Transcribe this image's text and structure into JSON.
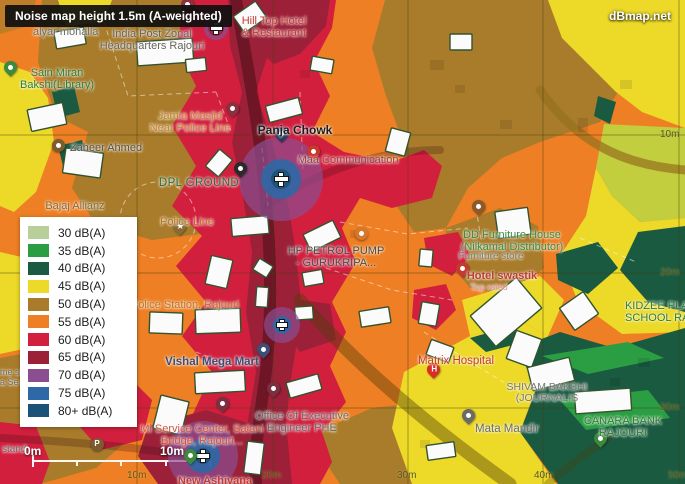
{
  "header": {
    "title": "Noise map height 1.5m (A-weighted)",
    "brand": "dBmap.net"
  },
  "colors": {
    "db30": "#b8cf9a",
    "db35": "#2b9e43",
    "db40": "#195a41",
    "db45": "#ecd928",
    "db50": "#a97c2b",
    "db55": "#ee7f24",
    "db60": "#d31f3e",
    "db65": "#9c2138",
    "db70": "#8b4f91",
    "db75": "#2e68a6",
    "db80": "#1c5278"
  },
  "legend": {
    "items": [
      {
        "label": "30 dB(A)",
        "color": "#b8cf9a"
      },
      {
        "label": "35 dB(A)",
        "color": "#2b9e43"
      },
      {
        "label": "40 dB(A)",
        "color": "#195a41"
      },
      {
        "label": "45 dB(A)",
        "color": "#ecd928"
      },
      {
        "label": "50 dB(A)",
        "color": "#a97c2b"
      },
      {
        "label": "55 dB(A)",
        "color": "#ee7f24"
      },
      {
        "label": "60 dB(A)",
        "color": "#d31f3e"
      },
      {
        "label": "65 dB(A)",
        "color": "#9c2138"
      },
      {
        "label": "70 dB(A)",
        "color": "#8b4f91"
      },
      {
        "label": "75 dB(A)",
        "color": "#2e68a6"
      },
      {
        "label": "80+ dB(A)",
        "color": "#1c5278"
      }
    ]
  },
  "scale_bar": {
    "start_label": "0m",
    "end_label": "10m"
  },
  "grid": {
    "bottom_labels": [
      {
        "text": "10m",
        "x": 137
      },
      {
        "text": "20m",
        "x": 272
      },
      {
        "text": "30m",
        "x": 407
      },
      {
        "text": "40m",
        "x": 544
      },
      {
        "text": "50m",
        "x": 678
      }
    ],
    "right_labels": [
      {
        "text": "10m",
        "y": 129
      },
      {
        "text": "20m",
        "y": 267
      },
      {
        "text": "30m",
        "y": 402
      }
    ]
  },
  "map": {
    "labels": [
      {
        "name": "label-alyar-mohalla",
        "lines": [
          "alyar mohalla"
        ],
        "x": 33,
        "y": 27,
        "color": "#6e6a60",
        "size": 11,
        "align": "left"
      },
      {
        "name": "label-india-post",
        "lines": [
          "India Post Zonal",
          "Headquarters Rajouri"
        ],
        "x": 152,
        "y": 29,
        "color": "#67635b",
        "size": 11
      },
      {
        "name": "label-hilltop-hotel",
        "lines": [
          "Hill Top Hotel",
          "& Restaurant"
        ],
        "x": 274,
        "y": 16,
        "color": "#c5392f",
        "size": 11
      },
      {
        "name": "label-sain-miran-library",
        "lines": [
          "Sain Miran",
          "Bakshi(Library)"
        ],
        "x": 57,
        "y": 68,
        "color": "#2f7d32",
        "size": 11
      },
      {
        "name": "label-jamia-masjid",
        "lines": [
          "Jamia Masjid",
          "Near Police Line"
        ],
        "x": 190,
        "y": 111,
        "color": "#c8812c",
        "size": 11
      },
      {
        "name": "label-panja-chowk",
        "lines": [
          "Panja Chowk"
        ],
        "x": 295,
        "y": 124,
        "color": "#1c1c1e",
        "size": 12,
        "bold": true
      },
      {
        "name": "label-maa-communication",
        "lines": [
          "Maa Communication"
        ],
        "x": 348,
        "y": 155,
        "color": "#9a423a",
        "size": 11
      },
      {
        "name": "label-dpl-ground",
        "lines": [
          "DPL GROUND"
        ],
        "x": 199,
        "y": 177,
        "color": "#2e6b34",
        "size": 11.5,
        "spacing": 0.4
      },
      {
        "name": "label-zaheer-ahmed",
        "lines": [
          "Zaheer Ahmed"
        ],
        "x": 106,
        "y": 143,
        "color": "#565149",
        "size": 11
      },
      {
        "name": "label-bajaj-allianz",
        "lines": [
          "Bajaj Allianz"
        ],
        "x": 75,
        "y": 201,
        "color": "#8a6a33",
        "size": 11
      },
      {
        "name": "label-police-line",
        "lines": [
          "Police Line"
        ],
        "x": 187,
        "y": 217,
        "color": "#bd7222",
        "size": 11
      },
      {
        "name": "label-hp-petrol-pump",
        "lines": [
          "HP PETROL PUMP",
          "- GURUKRIPA..."
        ],
        "x": 336,
        "y": 246,
        "color": "#4a4a46",
        "size": 11
      },
      {
        "name": "label-dd-furniture",
        "lines": [
          "DD Furniture House",
          "(Nilkamal Distributor)"
        ],
        "x": 512,
        "y": 230,
        "color": "#3c8a3f",
        "size": 11
      },
      {
        "name": "label-furniture-store",
        "lines": [
          "Furniture store"
        ],
        "x": 491,
        "y": 252,
        "color": "#7b7b72",
        "size": 10
      },
      {
        "name": "label-hotel-swastik",
        "lines": [
          "Hotel swastik"
        ],
        "x": 502,
        "y": 271,
        "color": "#c5392f",
        "size": 11,
        "bold": true
      },
      {
        "name": "label-top-rated",
        "lines": [
          "Top rated"
        ],
        "x": 489,
        "y": 283,
        "color": "#e8918f",
        "size": 9
      },
      {
        "name": "label-kidzee-school",
        "lines": [
          "KIDZEE PLAY",
          "SCHOOL RAJ"
        ],
        "x": 660,
        "y": 301,
        "color": "#2f7d32",
        "size": 11
      },
      {
        "name": "label-police-station",
        "lines": [
          "Police Station, Rajouri"
        ],
        "x": 185,
        "y": 300,
        "color": "#bd7222",
        "size": 11
      },
      {
        "name": "label-vishal-mega-mart",
        "lines": [
          "Vishal Mega Mart"
        ],
        "x": 212,
        "y": 356,
        "color": "#3d4d73",
        "size": 11.5,
        "bold": true
      },
      {
        "name": "label-matrix-hospital",
        "lines": [
          "Matrix Hospital"
        ],
        "x": 456,
        "y": 355,
        "color": "#c5392f",
        "size": 11.5
      },
      {
        "name": "label-office-phe",
        "lines": [
          "Office Of Executive",
          "Engineer PHE"
        ],
        "x": 302,
        "y": 411,
        "color": "#6a6a64",
        "size": 11
      },
      {
        "name": "label-shivam-bakshi",
        "lines": [
          "SHIVAM BAKSHI",
          "(JOURNALIS"
        ],
        "x": 547,
        "y": 382,
        "color": "#77776e",
        "size": 10.5
      },
      {
        "name": "label-mata-mandir",
        "lines": [
          "Mata Mandir"
        ],
        "x": 507,
        "y": 423,
        "color": "#6a6a64",
        "size": 11.5
      },
      {
        "name": "label-canara-bank",
        "lines": [
          "CANARA BANK",
          "RAJOURI"
        ],
        "x": 623,
        "y": 416,
        "color": "#2f7d32",
        "size": 11
      },
      {
        "name": "label-mi-service-center",
        "lines": [
          "Mi Service Center, Salani",
          "Bridge, Rajouri..."
        ],
        "x": 202,
        "y": 424,
        "color": "#d4543a",
        "size": 11
      },
      {
        "name": "label-new-ashiyana",
        "lines": [
          "New Ashiyana"
        ],
        "x": 215,
        "y": 476,
        "color": "#c5392f",
        "size": 11,
        "bold": true
      },
      {
        "name": "label-stand",
        "lines": [
          "stand"
        ],
        "x": 2,
        "y": 445,
        "color": "#6e6a60",
        "size": 10,
        "align": "left"
      },
      {
        "name": "label-edge-partial",
        "lines": [
          "me s",
          "a Se"
        ],
        "x": 0,
        "y": 368,
        "color": "#6e6a60",
        "size": 9,
        "align": "left"
      }
    ],
    "pins": [
      {
        "name": "mosque-pin",
        "x": 187,
        "y": 13,
        "color": "#8c2f3f"
      },
      {
        "name": "jamia-masjid-pin",
        "x": 232,
        "y": 117,
        "color": "#8c2f3f"
      },
      {
        "name": "panja-chowk-pin",
        "x": 281,
        "y": 142,
        "color": "#263a5e"
      },
      {
        "name": "maa-communication-pin",
        "x": 313,
        "y": 160,
        "color": "#c5392f"
      },
      {
        "name": "dpl-ground-pin",
        "x": 240,
        "y": 177,
        "color": "#2b2b2b"
      },
      {
        "name": "police-line-pin",
        "x": 179,
        "y": 235,
        "color": "#8a6a33",
        "glyph": "★"
      },
      {
        "name": "zaheer-ahmed-pin",
        "x": 58,
        "y": 145,
        "color": "#7a5c2e",
        "shape": "circle"
      },
      {
        "name": "library-pin",
        "x": 10,
        "y": 76,
        "color": "#3b8a3e"
      },
      {
        "name": "fuel-station-icon",
        "x": 361,
        "y": 233,
        "color": "#d8772a",
        "shape": "circle"
      },
      {
        "name": "dd-furniture-pin",
        "x": 478,
        "y": 215,
        "color": "#8a5a2a"
      },
      {
        "name": "hotel-swastik-pin",
        "x": 462,
        "y": 277,
        "color": "#c5392f"
      },
      {
        "name": "matrix-hospital-pin",
        "x": 433,
        "y": 378,
        "color": "#d93025",
        "glyph": "H"
      },
      {
        "name": "vishal-mega-mart-pin",
        "x": 263,
        "y": 358,
        "color": "#3d4d73"
      },
      {
        "name": "office-phe-pin",
        "x": 273,
        "y": 397,
        "color": "#7a3040"
      },
      {
        "name": "salani-bridge-pin",
        "x": 222,
        "y": 412,
        "color": "#7a3040"
      },
      {
        "name": "mata-mandir-pin",
        "x": 468,
        "y": 424,
        "color": "#6a6a66"
      },
      {
        "name": "canara-bank-pin",
        "x": 600,
        "y": 447,
        "color": "#3b8a3e"
      },
      {
        "name": "bottom-green-pin",
        "x": 190,
        "y": 464,
        "color": "#3b8a3e"
      },
      {
        "name": "parking-icon",
        "x": 97,
        "y": 444,
        "color": "#7a5c2e",
        "shape": "circle",
        "glyph": "P"
      }
    ],
    "hotspots": [
      {
        "name": "noise-hotspot-top",
        "x": 216,
        "y": 28,
        "cross": 13,
        "rings": [
          {
            "r": 12,
            "color": "#8b4f91",
            "opacity": 0.75
          },
          {
            "r": 8,
            "color": "#9c2138",
            "opacity": 0.9
          }
        ]
      },
      {
        "name": "noise-hotspot-panja-chowk",
        "x": 281,
        "y": 179,
        "cross": 15,
        "rings": [
          {
            "r": 42,
            "color": "#8b4f91",
            "opacity": 0.7
          },
          {
            "r": 20,
            "color": "#2e68a6",
            "opacity": 0.9
          },
          {
            "r": 10,
            "color": "#1c5278",
            "opacity": 0.95
          }
        ]
      },
      {
        "name": "noise-hotspot-mid",
        "x": 282,
        "y": 325,
        "cross": 12,
        "rings": [
          {
            "r": 18,
            "color": "#8b4f91",
            "opacity": 0.7
          },
          {
            "r": 9,
            "color": "#2e68a6",
            "opacity": 0.9
          }
        ]
      },
      {
        "name": "noise-hotspot-bridge",
        "x": 203,
        "y": 456,
        "cross": 14,
        "rings": [
          {
            "r": 35,
            "color": "#8b4f91",
            "opacity": 0.7
          },
          {
            "r": 17,
            "color": "#2e68a6",
            "opacity": 0.9
          },
          {
            "r": 8,
            "color": "#1c5278",
            "opacity": 0.95
          }
        ]
      }
    ]
  }
}
